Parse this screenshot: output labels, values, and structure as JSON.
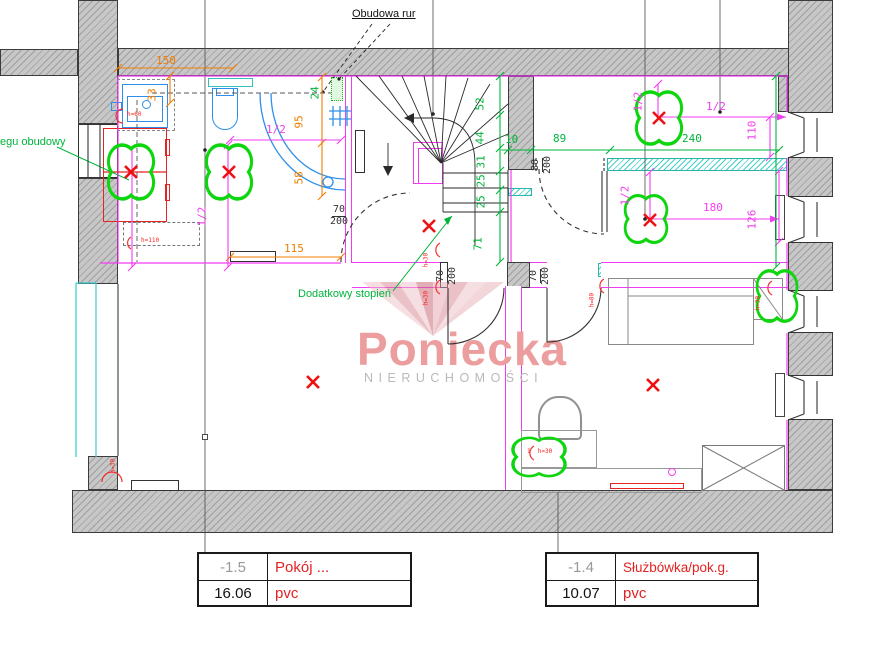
{
  "watermark": {
    "brand": "Poniecka",
    "subtitle": "NIERUCHOMOŚCI"
  },
  "labels": {
    "obudowa_rur": "Obudowa rur",
    "egu_obudowy": "egu obudowy",
    "dodatkowy_stopien": "Dodatkowy stopień"
  },
  "tables": {
    "left": {
      "room_no": "-1.5",
      "room_name": "Pokój ...",
      "area": "16.06",
      "floor": "pvc"
    },
    "right": {
      "room_no": "-1.4",
      "room_name": "Służbówka/pok.g.",
      "area": "10.07",
      "floor": "pvc"
    }
  },
  "colors": {
    "dim_orange": "#f07d00",
    "dim_magenta": "#f23cf2",
    "dim_green": "#00b43c",
    "cloud_green": "#0ed60e",
    "mark_red": "#ee1111",
    "fixture_blue": "#2f8fe8",
    "casing_cyan": "#38cccc",
    "wall_gray": "#b5b5b5",
    "table_red": "#e32222"
  },
  "annotations": [
    {
      "name": "dim-150",
      "text": "150",
      "x": 156,
      "y": 55,
      "color": "#f07d00"
    },
    {
      "name": "dim-33",
      "text": "33",
      "x": 158,
      "y": 103,
      "color": "#f07d00",
      "rot": -90
    },
    {
      "name": "dim-95",
      "text": "95",
      "x": 305,
      "y": 130,
      "color": "#f07d00",
      "rot": -90
    },
    {
      "name": "dim-58",
      "text": "58",
      "x": 305,
      "y": 186,
      "color": "#f07d00",
      "rot": -90
    },
    {
      "name": "dim-115",
      "text": "115",
      "x": 284,
      "y": 243,
      "color": "#f07d00"
    },
    {
      "name": "dim-24",
      "text": "24",
      "x": 321,
      "y": 101,
      "color": "#00b43c",
      "rot": -90
    },
    {
      "name": "dim-52",
      "text": "52",
      "x": 486,
      "y": 112,
      "color": "#00b43c",
      "rot": -90
    },
    {
      "name": "dim-44",
      "text": "44",
      "x": 486,
      "y": 146,
      "color": "#00b43c",
      "rot": -90
    },
    {
      "name": "dim-31",
      "text": "31",
      "x": 487,
      "y": 170,
      "color": "#00b43c",
      "rot": -90
    },
    {
      "name": "dim-25a",
      "text": "25",
      "x": 487,
      "y": 189,
      "color": "#00b43c",
      "rot": -90
    },
    {
      "name": "dim-25b",
      "text": "25",
      "x": 487,
      "y": 210,
      "color": "#00b43c",
      "rot": -90
    },
    {
      "name": "dim-71",
      "text": "71",
      "x": 484,
      "y": 252,
      "color": "#00b43c",
      "rot": -90
    },
    {
      "name": "dim-10",
      "text": "10",
      "x": 505,
      "y": 134,
      "color": "#00b43c"
    },
    {
      "name": "dim-89",
      "text": "89",
      "x": 553,
      "y": 133,
      "color": "#00b43c"
    },
    {
      "name": "dim-240",
      "text": "240",
      "x": 682,
      "y": 133,
      "color": "#00b43c"
    },
    {
      "name": "dim-half-bath-h",
      "text": "1/2",
      "x": 266,
      "y": 124,
      "color": "#f23cf2"
    },
    {
      "name": "dim-half-bath-v",
      "text": "1/2",
      "x": 208,
      "y": 228,
      "color": "#f23cf2",
      "rot": -90
    },
    {
      "name": "dim-half-topright-v",
      "text": "1/2",
      "x": 644,
      "y": 113,
      "color": "#f23cf2",
      "rot": -90
    },
    {
      "name": "dim-half-topright-h",
      "text": "1/2",
      "x": 706,
      "y": 101,
      "color": "#f23cf2"
    },
    {
      "name": "dim-110",
      "text": "110",
      "x": 758,
      "y": 142,
      "color": "#f23cf2",
      "rot": -90
    },
    {
      "name": "dim-half-mid-v",
      "text": "1/2",
      "x": 631,
      "y": 207,
      "color": "#f23cf2",
      "rot": -90
    },
    {
      "name": "dim-180",
      "text": "180",
      "x": 703,
      "y": 202,
      "color": "#f23cf2"
    },
    {
      "name": "dim-126",
      "text": "126",
      "x": 758,
      "y": 231,
      "color": "#f23cf2",
      "rot": -90
    },
    {
      "name": "door-70-200-bath",
      "text": "70/200",
      "frac": true,
      "x": 330,
      "y": 205,
      "color": "#333333",
      "s": 10
    },
    {
      "name": "door-70-200-a",
      "text": "70/200",
      "frac": true,
      "x": 458,
      "y": 287,
      "color": "#333333",
      "s": 10,
      "rot": -90
    },
    {
      "name": "door-70-200-b",
      "text": "70/200",
      "frac": true,
      "x": 551,
      "y": 287,
      "color": "#333333",
      "s": 10,
      "rot": -90
    },
    {
      "name": "door-80-200",
      "text": "80/200",
      "frac": true,
      "x": 553,
      "y": 176,
      "color": "#333333",
      "s": 10,
      "rot": -90
    },
    {
      "name": "h60",
      "text": "h=60",
      "x": 127,
      "y": 112,
      "color": "#ff2222",
      "s": 6
    },
    {
      "name": "h110",
      "text": "h=110",
      "x": 141,
      "y": 238,
      "color": "#ff2222",
      "s": 6
    },
    {
      "name": "h30-stair-1",
      "text": "h=30",
      "x": 430,
      "y": 268,
      "color": "#ff2222",
      "s": 6,
      "rot": -90
    },
    {
      "name": "h30-stair-2",
      "text": "h=30",
      "x": 430,
      "y": 306,
      "color": "#ff2222",
      "s": 6,
      "rot": -90
    },
    {
      "name": "h80-bed",
      "text": "h=80",
      "x": 596,
      "y": 308,
      "color": "#ff2222",
      "s": 6,
      "rot": -90
    },
    {
      "name": "h30-nightstand",
      "text": "h=30",
      "x": 762,
      "y": 311,
      "color": "#ff2222",
      "s": 6,
      "rot": -90
    },
    {
      "name": "h30-bottomleft",
      "text": "h=30",
      "x": 117,
      "y": 474,
      "color": "#ff2222",
      "s": 6,
      "rot": -90
    },
    {
      "name": "h30-cloud-bottom",
      "text": "1  h=30",
      "x": 527,
      "y": 449,
      "color": "#ff2222",
      "s": 6
    }
  ]
}
